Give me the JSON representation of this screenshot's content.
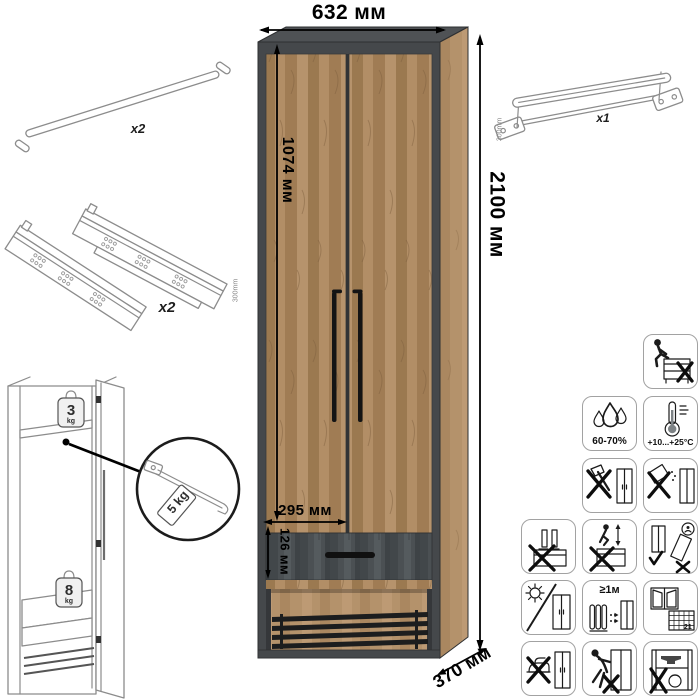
{
  "dimensions": {
    "width": "632 мм",
    "height": "2100 мм",
    "inner_height": "1074 мм",
    "niche_width": "295 мм",
    "drawer_front": "126 мм",
    "depth": "370 мм"
  },
  "parts": {
    "handle": {
      "qty": "x2"
    },
    "slides": {
      "qty": "x2",
      "size": "300mm"
    },
    "rail": {
      "qty": "x1",
      "size": "300mm"
    }
  },
  "loads": {
    "shelf": {
      "value": "3",
      "unit": "kg"
    },
    "drawer": {
      "value": "8",
      "unit": "kg"
    },
    "rail_tag": "5 kg"
  },
  "care": {
    "humidity": "60-70%",
    "temperature": "+10...+25°C",
    "heater_distance": "≥1м",
    "days": "21"
  }
}
